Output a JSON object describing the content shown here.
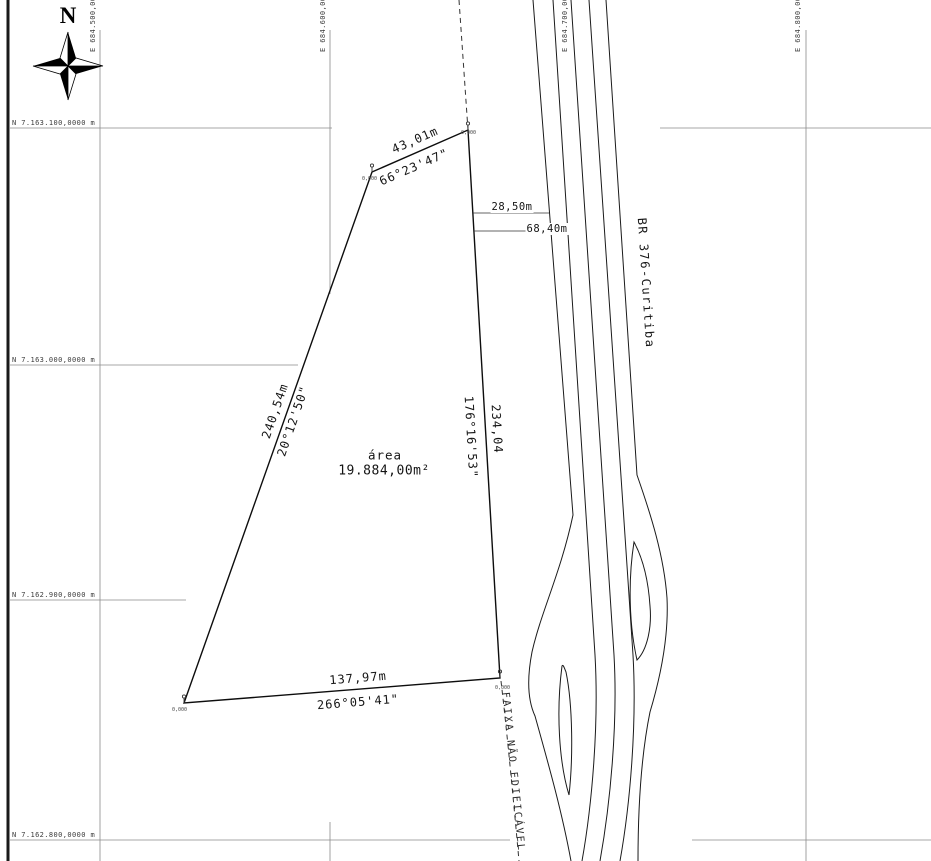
{
  "drawing": {
    "compass_label": "N",
    "grid": {
      "north_labels": [
        {
          "text": "N 7.163.100,0000 m"
        },
        {
          "text": "N 7.163.000,0000 m"
        },
        {
          "text": "N 7.162.900,0000 m"
        },
        {
          "text": "N 7.162.800,0000 m"
        }
      ],
      "east_labels": [
        {
          "text": "E 684.500,0000"
        },
        {
          "text": "E 684.600,0000"
        },
        {
          "text": "E 684.700,0000"
        },
        {
          "text": "E 684.800,0000"
        }
      ]
    },
    "parcel": {
      "area_title": "área",
      "area_value": "19.884,00m²",
      "vertex_elevation": "0,000",
      "edges": {
        "north": {
          "length": "43,01m",
          "azimuth": "66°23'47\""
        },
        "east": {
          "length": "234,04",
          "azimuth": "176°16'53\""
        },
        "south": {
          "length": "137,97m",
          "azimuth": "266°05'41\""
        },
        "west": {
          "length": "240,54m",
          "azimuth": "20°12'50\""
        }
      }
    },
    "road": {
      "name": "BR 376-Curitiba",
      "offset_dimensions": [
        {
          "label": "28,50m"
        },
        {
          "label": "68,40m"
        }
      ]
    },
    "restriction_strip": {
      "label": "FAIXA NÃO EDIFICÁVEL"
    }
  }
}
